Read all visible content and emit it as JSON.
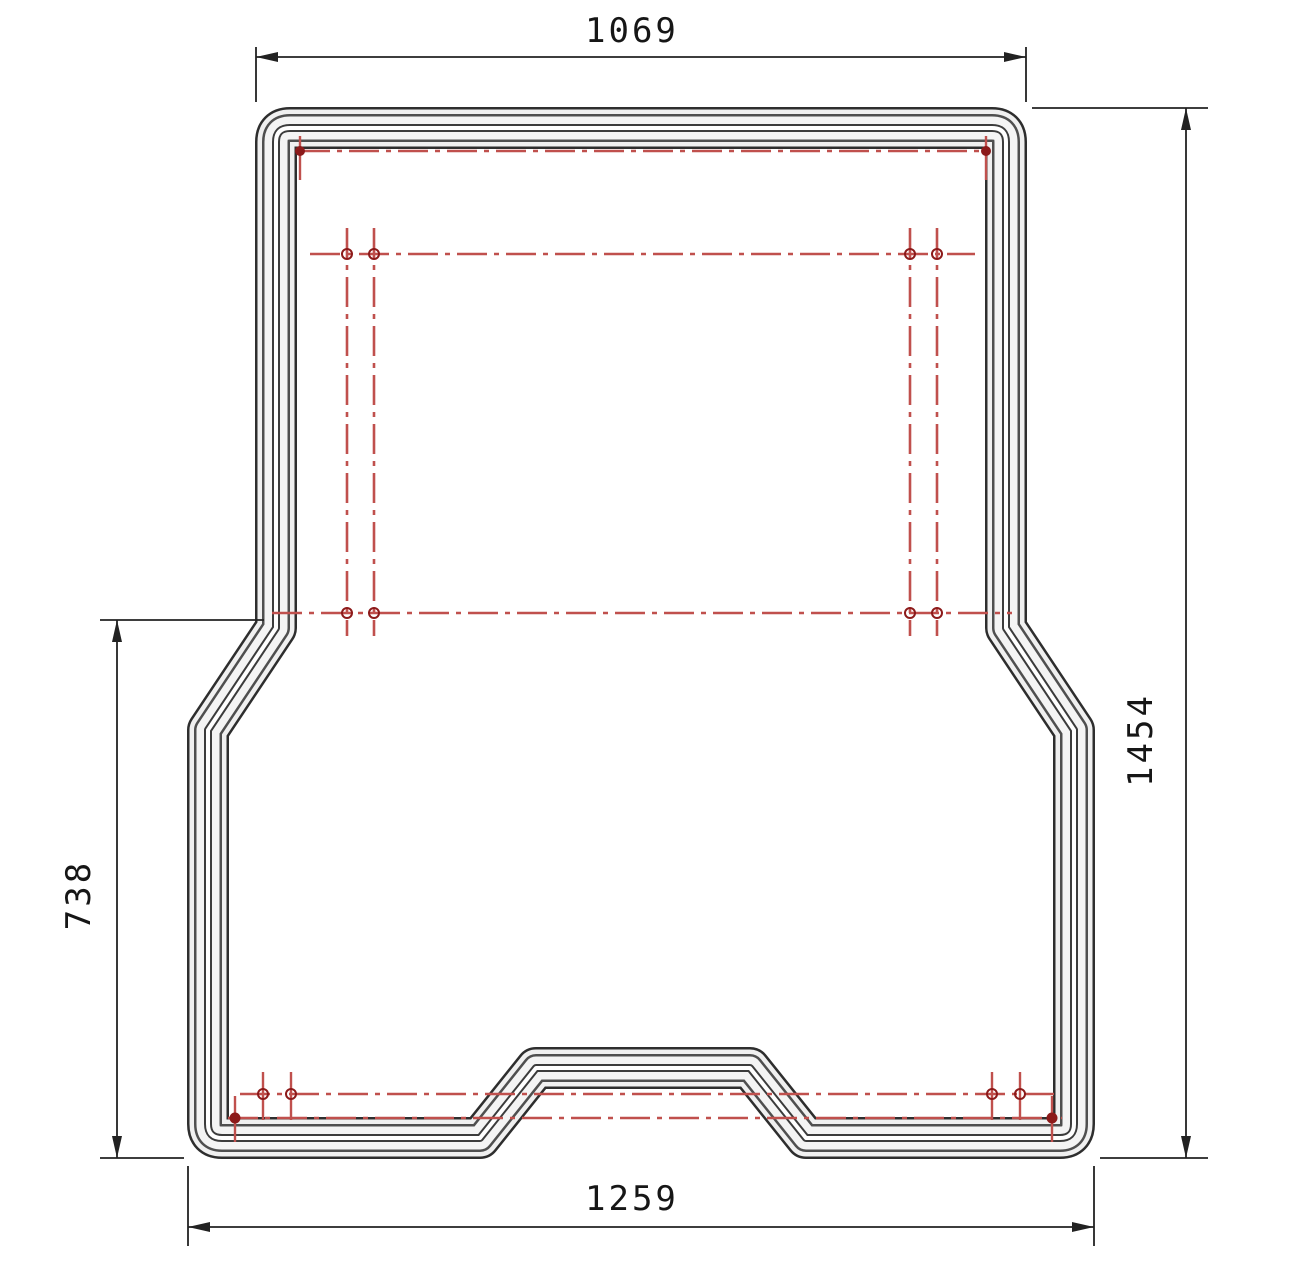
{
  "drawing": {
    "type": "technical-drawing-top-view",
    "subject": "truck-bed-mat",
    "dimensions": {
      "top_width": "1069",
      "total_height": "1454",
      "lower_height": "738",
      "bottom_width": "1259"
    },
    "colors": {
      "outline": "#2e2e2e",
      "rib": "#a8a8a8",
      "centerline_red": "#c0504d",
      "marker_red": "#8c1a1a",
      "background": "#ffffff"
    }
  }
}
